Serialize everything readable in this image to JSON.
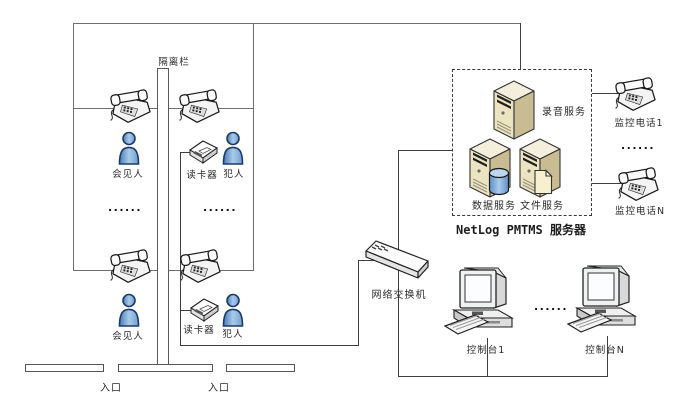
{
  "meeting_area": {
    "fence_label": "隔离栏",
    "row1": {
      "visitor_label": "会见人",
      "reader_label": "读卡器",
      "prisoner_label": "犯人"
    },
    "row2": {
      "visitor_label": "会见人",
      "reader_label": "读卡器",
      "prisoner_label": "犯人"
    },
    "ellipsis_visitor": "......",
    "ellipsis_prisoner": "......",
    "entrance_left": "入口",
    "entrance_right": "入口"
  },
  "server_box": {
    "recording_label": "录音服务",
    "data_label": "数据服务",
    "file_label": "文件服务",
    "caption": "NetLog PMTMS 服务器"
  },
  "monitor_phones": {
    "phone1_label": "监控电话1",
    "ellipsis": "......",
    "phoneN_label": "监控电话N"
  },
  "network": {
    "switch_label": "网络交换机"
  },
  "consoles": {
    "console1_label": "控制台1",
    "ellipsis": "......",
    "consoleN_label": "控制台N"
  },
  "colors": {
    "wall_line": "#6e6e6e",
    "cable_line": "#3f3f3f",
    "person_blue": "#6f9fd4",
    "server_front": "#ece3c0",
    "server_side": "#c9bc92",
    "server_top": "#f4efdd",
    "database_blue": "#5e90c8",
    "file_yellow": "#f6f0cf"
  }
}
